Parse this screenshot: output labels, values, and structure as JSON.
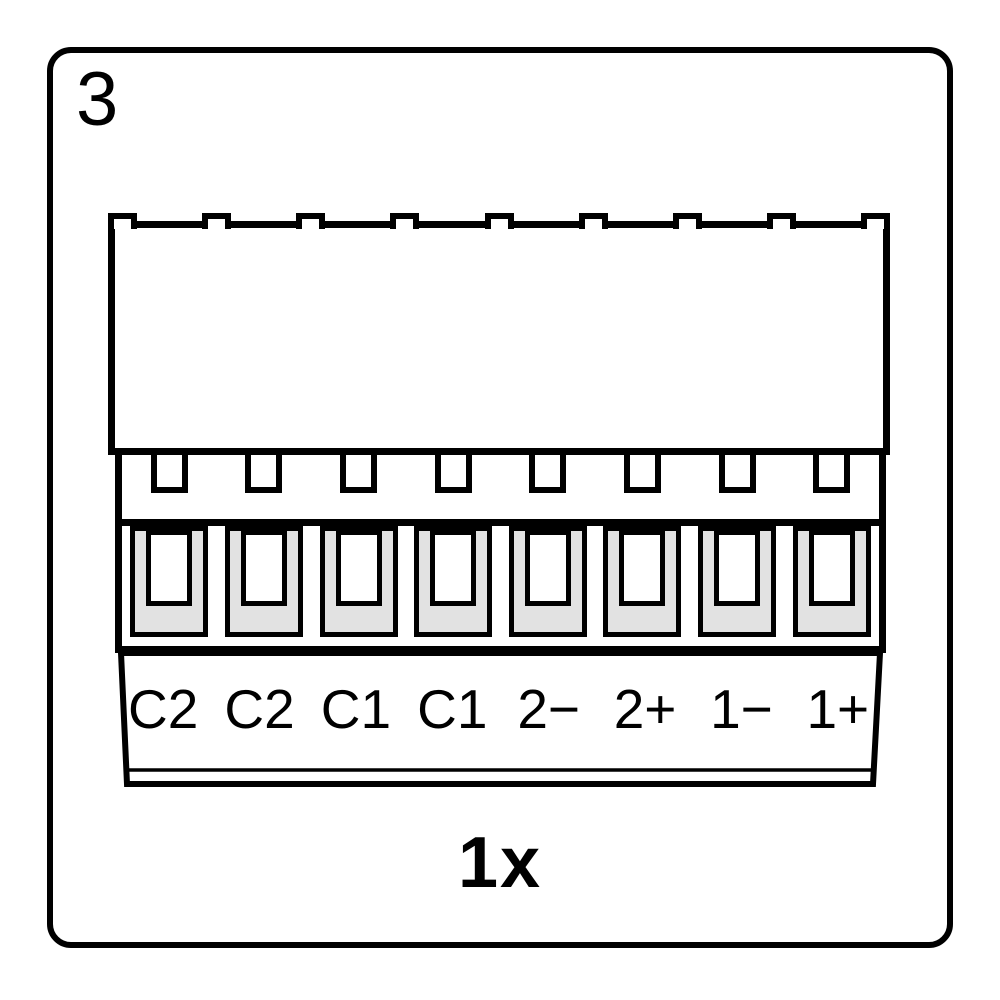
{
  "step": {
    "number": "3"
  },
  "connector": {
    "name": "8-pin-terminal-block",
    "pin_count": 8,
    "pins": [
      "C2",
      "C2",
      "C1",
      "C1",
      "2−",
      "2+",
      "1−",
      "1+"
    ]
  },
  "quantity": {
    "label": "1x"
  },
  "colors": {
    "stroke": "#000000",
    "fill": "#ffffff",
    "terminal_gray": "#e2e2e2"
  }
}
